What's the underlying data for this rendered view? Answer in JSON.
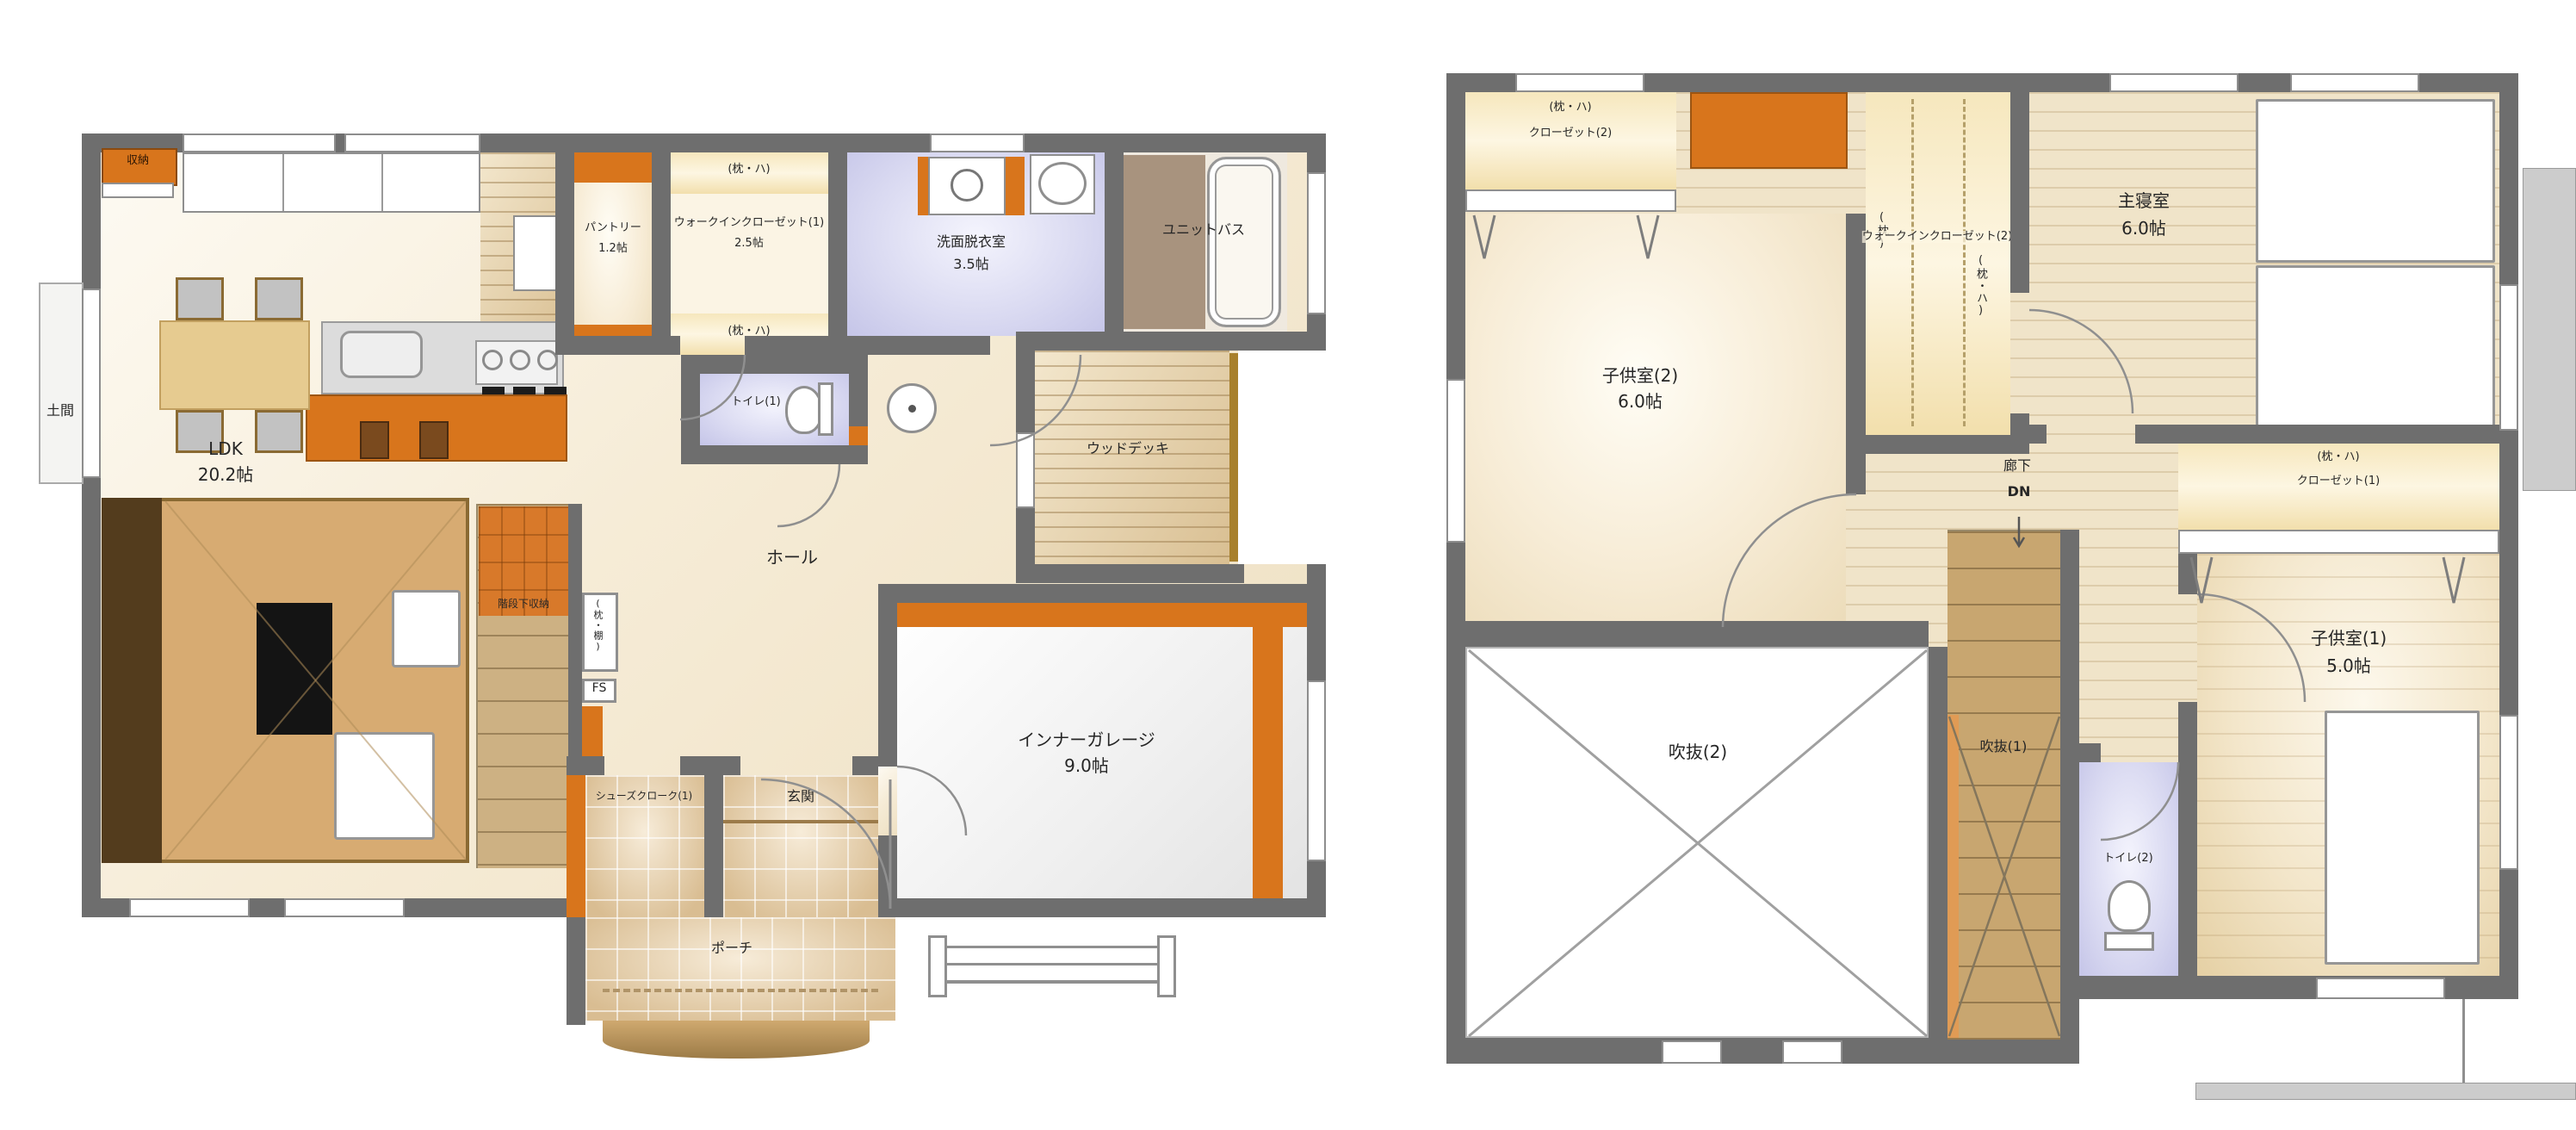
{
  "document_type": "floor-plan",
  "colors": {
    "wall": "#6e6e6e",
    "accent_orange": "#d8751c",
    "sanitary_lavender": "#d9d9f1",
    "wood": "#cdb183",
    "closet_yellow": "#f5e4b4",
    "eaves_gray": "#cccccc"
  },
  "floor1": {
    "storage": "収納",
    "doma": "土間",
    "ldk_name": "LDK",
    "ldk_size": "20.2帖",
    "pantry_name": "パントリー",
    "pantry_size": "1.2帖",
    "wic_shelf_top": "(枕・ハ)",
    "wic_name": "ウォークインクローゼット(1)",
    "wic_size": "2.5帖",
    "wic_shelf_bottom": "(枕・ハ)",
    "washroom_name": "洗面脱衣室",
    "washroom_size": "3.5帖",
    "unit_bath": "ユニットバス",
    "toilet": "トイレ(1)",
    "wood_deck": "ウッドデッキ",
    "hall": "ホール",
    "stair_storage": "階段下収納",
    "niche": "(枕・棚)",
    "fs": "FS",
    "up": "UP",
    "shoes_closet": "シューズクローク(1)",
    "genkan": "玄関",
    "garage_name": "インナーガレージ",
    "garage_size": "9.0帖",
    "porch": "ポーチ"
  },
  "floor2": {
    "closet2_shelf": "(枕・ハ)",
    "closet2_name": "クローゼット(2)",
    "kids2_name": "子供室(2)",
    "kids2_size": "6.0帖",
    "wic2_name": "ウォークインクローゼット(2)",
    "wic2_left": "(枕)",
    "wic2_right": "(枕・ハ)",
    "master_name": "主寝室",
    "master_size": "6.0帖",
    "hallway": "廊下",
    "dn": "DN",
    "closet1_shelf": "(枕・ハ)",
    "closet1_name": "クローゼット(1)",
    "kids1_name": "子供室(1)",
    "kids1_size": "5.0帖",
    "void2": "吹抜(2)",
    "void1": "吹抜(1)",
    "toilet2": "トイレ(2)"
  }
}
